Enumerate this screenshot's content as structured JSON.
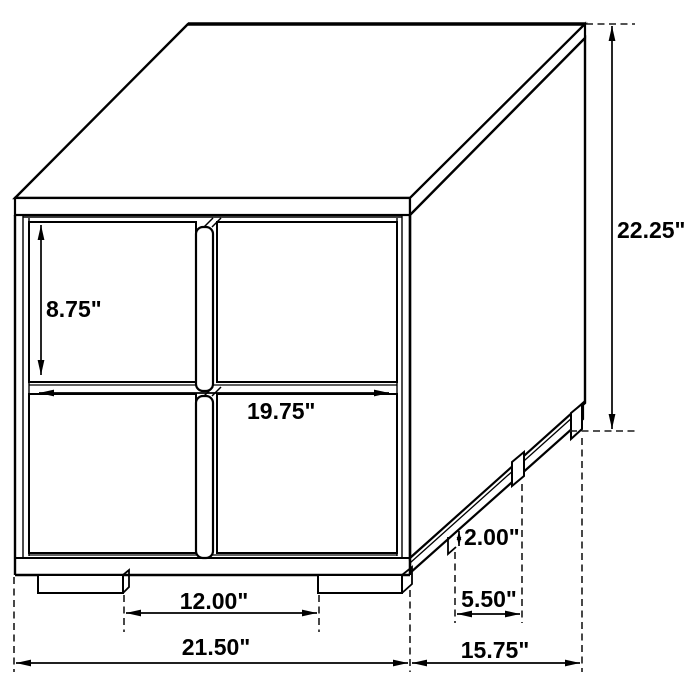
{
  "diagram": {
    "background_color": "#ffffff",
    "line_color": "#000000",
    "subject": "two-drawer-nightstand-isometric-dimension-drawing",
    "dimension_labels": {
      "drawer_height": "8.75\"",
      "overall_height": "22.25\"",
      "drawer_width": "19.75\"",
      "leg_height": "2.00\"",
      "side_leg_spacing": "5.50\"",
      "front_leg_spacing": "12.00\"",
      "overall_width": "21.50\"",
      "overall_depth": "15.75\""
    }
  }
}
